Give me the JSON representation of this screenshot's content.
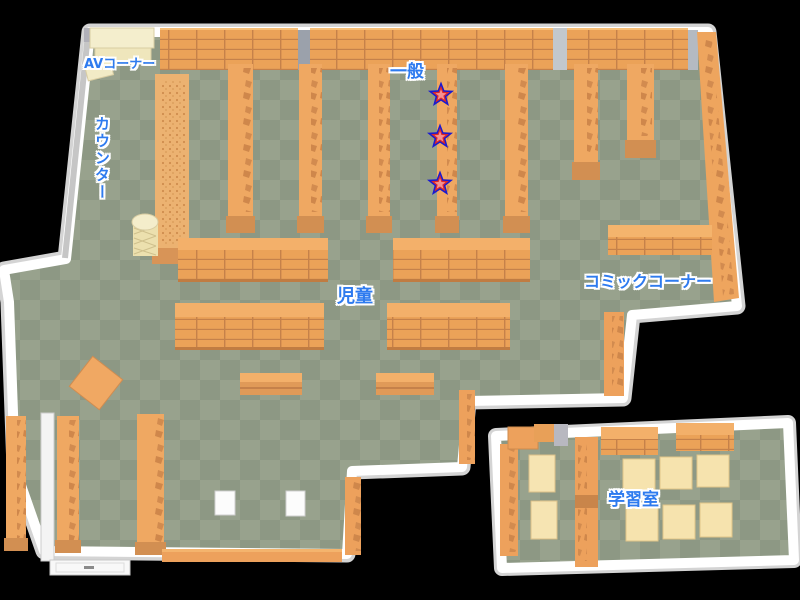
{
  "map": {
    "areas": {
      "av_corner": {
        "label": "AVコーナー"
      },
      "counter": {
        "label": "カウンター"
      },
      "general": {
        "label": "一般"
      },
      "children": {
        "label": "児童"
      },
      "comic_corner": {
        "label": "コミックコーナー"
      },
      "study_room": {
        "label": "学習室"
      }
    },
    "markers": {
      "icon": "star",
      "count": 3,
      "area_label": "一般"
    },
    "colors": {
      "background": "#000000",
      "floor_dark": "#8d9884",
      "floor_light": "#98a28d",
      "shelf_top": "#f3b06a",
      "shelf_body": "#efa862",
      "shelf_front": "#d28f52",
      "shelf_line": "#c5814a",
      "wall_white": "#ffffff",
      "wall_shadow": "#d4d4d4",
      "cream_shelf": "#f4eecd",
      "desk_cream": "#f6e3ae",
      "label_blue": "#2e7bef",
      "star_outline": "#1a1ad0",
      "star_mid": "#dd2828",
      "star_center": "#f59090"
    }
  }
}
